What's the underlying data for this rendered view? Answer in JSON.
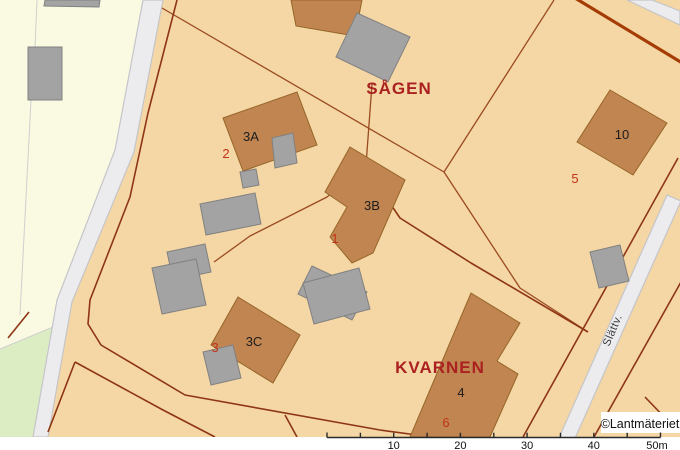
{
  "map": {
    "block_labels": [
      {
        "text": "SÅGEN"
      },
      {
        "text": "KVARNEN"
      }
    ],
    "building_labels": [
      {
        "text": "3A"
      },
      {
        "text": "3B"
      },
      {
        "text": "3C"
      },
      {
        "text": "10"
      },
      {
        "text": "4"
      }
    ],
    "parcel_numbers": [
      {
        "text": "2"
      },
      {
        "text": "1"
      },
      {
        "text": "3"
      },
      {
        "text": "5"
      },
      {
        "text": "6"
      }
    ],
    "street_label": {
      "text": "Slättv."
    },
    "copyright": "©Lantmäteriet",
    "scale_bar": {
      "unit": "m",
      "tick_interval_m": 5,
      "labels": [
        "10",
        "20",
        "30",
        "40",
        "50m"
      ]
    }
  },
  "colors": {
    "parcel_fill": "#f4d7a4",
    "other_area_fill": "#fafae3",
    "green_area_fill": "#dcedc3",
    "road_fill": "#ececee",
    "building_brown": "#c08550",
    "building_gray": "#a3a3a3",
    "boundary_dark_red": "#8e3514",
    "boundary_light_brown": "#9a4a20",
    "boundary_thick_red": "#a63c05",
    "block_label_red": "#ab2020",
    "parcel_number_red": "#c23318",
    "label_black": "#1d1d1d"
  }
}
